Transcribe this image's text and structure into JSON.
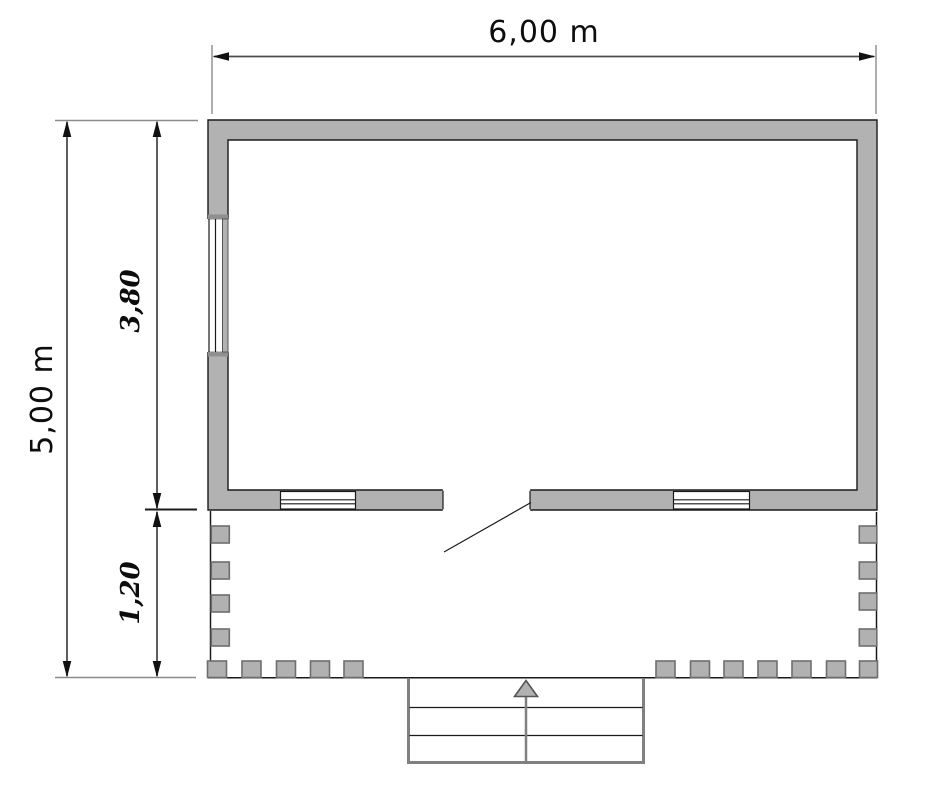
{
  "drawing": {
    "type": "architectural-floor-plan",
    "labels": {
      "overall_width": "6,00 m",
      "overall_height": "5,00 m",
      "room_depth": "3,80",
      "porch_depth": "1,20"
    },
    "colors": {
      "background": "#ffffff",
      "wall_fill": "#b2b2b2",
      "outline": "#1a1a1a",
      "dimension_line": "#4d4d4d",
      "extension_line": "#8c8c8c",
      "post_fill": "#b1b1b1",
      "post_stroke": "#6e6e6e",
      "steps_outline": "#808080",
      "entry_arrow_fill": "#b1b1b1"
    },
    "icons": {
      "entry_arrow": "up-arrow-icon"
    }
  }
}
